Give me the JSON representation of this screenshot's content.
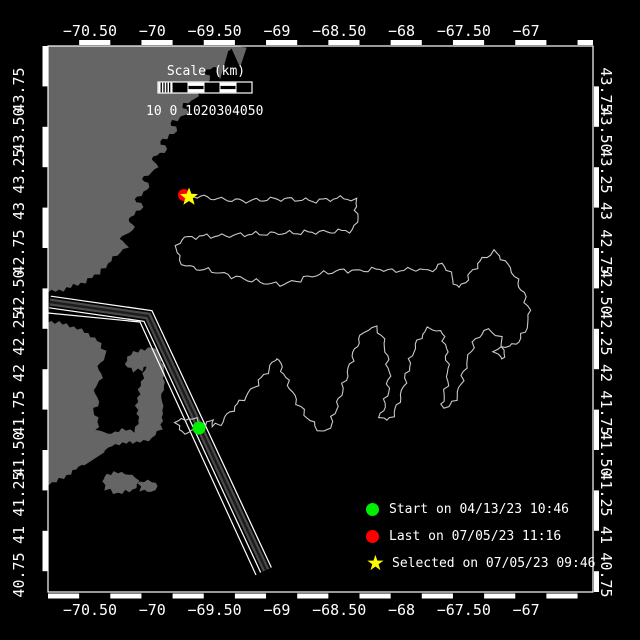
{
  "axes": {
    "lon": [
      {
        "label": "−70.50",
        "value": -70.5
      },
      {
        "label": "−70",
        "value": -70
      },
      {
        "label": "−69.50",
        "value": -69.5
      },
      {
        "label": "−69",
        "value": -69
      },
      {
        "label": "−68.50",
        "value": -68.5
      },
      {
        "label": "−68",
        "value": -68
      },
      {
        "label": "−67.50",
        "value": -67.5
      },
      {
        "label": "−67",
        "value": -67
      }
    ],
    "lat": [
      {
        "label": "43.75",
        "value": 43.75
      },
      {
        "label": "43.50",
        "value": 43.5
      },
      {
        "label": "43.25",
        "value": 43.25
      },
      {
        "label": "43",
        "value": 43
      },
      {
        "label": "42.75",
        "value": 42.75
      },
      {
        "label": "42.50",
        "value": 42.5
      },
      {
        "label": "42.25",
        "value": 42.25
      },
      {
        "label": "42",
        "value": 42
      },
      {
        "label": "41.75",
        "value": 41.75
      },
      {
        "label": "41.50",
        "value": 41.5
      },
      {
        "label": "41.25",
        "value": 41.25
      },
      {
        "label": "41",
        "value": 41
      },
      {
        "label": "40.75",
        "value": 40.75
      }
    ]
  },
  "scale_bar": {
    "title": "Scale (km)",
    "tick_text": "10 0 1020304050"
  },
  "legend": {
    "star_glyph": "★",
    "items": [
      {
        "marker": "circle",
        "color": "#00ee00",
        "label": "Start on 04/13/23 10:46"
      },
      {
        "marker": "circle",
        "color": "#ff0000",
        "label": "Last on 07/05/23 11:16"
      },
      {
        "marker": "star",
        "color": "#ffff00",
        "label": "Selected on 07/05/23 09:46"
      }
    ]
  },
  "markers": {
    "start": {
      "x": 199,
      "y": 428,
      "color": "#00ee00"
    },
    "last": {
      "x": 184,
      "y": 195,
      "color": "#ff0000"
    },
    "selected": {
      "x": 189,
      "y": 197,
      "color": "#ffff00"
    }
  },
  "map": {
    "land_color": "#656565",
    "track_color": "#c9c9c9",
    "frame_color": "#ffffff",
    "lane_colors": {
      "edge": "#ffffff",
      "gap": "#000000",
      "fill": "#4a4a4a",
      "core": "#1c1c1c"
    },
    "land": [
      {
        "name": "massachusetts-north-coast",
        "rough": true,
        "points": [
          [
            40,
            40
          ],
          [
            236,
            40
          ],
          [
            230,
            50
          ],
          [
            214,
            56
          ],
          [
            221,
            64
          ],
          [
            203,
            72
          ],
          [
            210,
            80
          ],
          [
            192,
            88
          ],
          [
            199,
            96
          ],
          [
            180,
            106
          ],
          [
            188,
            113
          ],
          [
            169,
            123
          ],
          [
            177,
            131
          ],
          [
            159,
            141
          ],
          [
            167,
            149
          ],
          [
            150,
            159
          ],
          [
            158,
            167
          ],
          [
            141,
            179
          ],
          [
            150,
            187
          ],
          [
            134,
            199
          ],
          [
            143,
            207
          ],
          [
            127,
            219
          ],
          [
            135,
            227
          ],
          [
            119,
            239
          ],
          [
            127,
            247
          ],
          [
            113,
            257
          ],
          [
            105,
            267
          ],
          [
            95,
            275
          ],
          [
            81,
            283
          ],
          [
            63,
            289
          ],
          [
            40,
            293
          ]
        ]
      },
      {
        "name": "coast-finger-1",
        "rough": false,
        "points": [
          [
            190,
            46
          ],
          [
            197,
            70
          ],
          [
            205,
            48
          ]
        ]
      },
      {
        "name": "coast-finger-2",
        "rough": false,
        "points": [
          [
            210,
            46
          ],
          [
            220,
            78
          ],
          [
            228,
            50
          ]
        ]
      },
      {
        "name": "coast-finger-3",
        "rough": false,
        "points": [
          [
            231,
            46
          ],
          [
            240,
            66
          ],
          [
            246,
            48
          ]
        ]
      },
      {
        "name": "cape-cod-mainland",
        "rough": true,
        "points": [
          [
            40,
            320
          ],
          [
            70,
            326
          ],
          [
            88,
            334
          ],
          [
            100,
            344
          ],
          [
            106,
            356
          ],
          [
            97,
            366
          ],
          [
            102,
            378
          ],
          [
            93,
            390
          ],
          [
            99,
            402
          ],
          [
            92,
            412
          ],
          [
            99,
            422
          ],
          [
            95,
            430
          ],
          [
            108,
            434
          ],
          [
            122,
            430
          ],
          [
            134,
            432
          ],
          [
            139,
            424
          ],
          [
            137,
            410
          ],
          [
            139,
            394
          ],
          [
            143,
            378
          ],
          [
            147,
            366
          ],
          [
            142,
            370
          ],
          [
            134,
            370
          ],
          [
            126,
            364
          ],
          [
            131,
            355
          ],
          [
            141,
            350
          ],
          [
            152,
            348
          ],
          [
            160,
            353
          ],
          [
            163,
            366
          ],
          [
            164,
            382
          ],
          [
            161,
            398
          ],
          [
            163,
            414
          ],
          [
            160,
            428
          ],
          [
            152,
            438
          ],
          [
            140,
            442
          ],
          [
            126,
            441
          ],
          [
            112,
            446
          ],
          [
            99,
            453
          ],
          [
            85,
            463
          ],
          [
            70,
            473
          ],
          [
            56,
            481
          ],
          [
            40,
            486
          ]
        ]
      },
      {
        "name": "elizabeth-islands",
        "rough": false,
        "points": [
          [
            78,
            458
          ],
          [
            98,
            447
          ],
          [
            104,
            452
          ],
          [
            84,
            465
          ]
        ]
      },
      {
        "name": "marthas-vineyard",
        "rough": true,
        "points": [
          [
            104,
            477
          ],
          [
            118,
            473
          ],
          [
            132,
            475
          ],
          [
            138,
            481
          ],
          [
            133,
            490
          ],
          [
            118,
            493
          ],
          [
            106,
            489
          ]
        ]
      },
      {
        "name": "nantucket",
        "rough": true,
        "points": [
          [
            140,
            483
          ],
          [
            152,
            481
          ],
          [
            158,
            486
          ],
          [
            151,
            492
          ],
          [
            141,
            490
          ]
        ]
      }
    ],
    "lane": {
      "center": [
        [
          50,
          302
        ],
        [
          148,
          316
        ],
        [
          266,
          570
        ]
      ],
      "parallel": [
        [
          48,
          313
        ],
        [
          140,
          322
        ],
        [
          256,
          575
        ]
      ]
    },
    "track": [
      [
        199,
        428
      ],
      [
        189,
        433
      ],
      [
        179,
        430
      ],
      [
        176,
        423
      ],
      [
        185,
        418
      ],
      [
        196,
        420
      ],
      [
        205,
        426
      ],
      [
        214,
        419
      ],
      [
        212,
        427
      ],
      [
        220,
        424
      ],
      [
        230,
        412
      ],
      [
        243,
        399
      ],
      [
        257,
        384
      ],
      [
        269,
        369
      ],
      [
        277,
        357
      ],
      [
        284,
        374
      ],
      [
        292,
        392
      ],
      [
        300,
        407
      ],
      [
        308,
        418
      ],
      [
        315,
        426
      ],
      [
        322,
        432
      ],
      [
        328,
        431
      ],
      [
        332,
        421
      ],
      [
        337,
        406
      ],
      [
        343,
        388
      ],
      [
        349,
        368
      ],
      [
        355,
        349
      ],
      [
        361,
        336
      ],
      [
        368,
        329
      ],
      [
        376,
        328
      ],
      [
        382,
        335
      ],
      [
        386,
        352
      ],
      [
        389,
        372
      ],
      [
        388,
        392
      ],
      [
        384,
        407
      ],
      [
        380,
        417
      ],
      [
        387,
        421
      ],
      [
        395,
        412
      ],
      [
        401,
        395
      ],
      [
        407,
        374
      ],
      [
        413,
        352
      ],
      [
        420,
        337
      ],
      [
        428,
        329
      ],
      [
        437,
        329
      ],
      [
        444,
        337
      ],
      [
        447,
        356
      ],
      [
        448,
        377
      ],
      [
        445,
        394
      ],
      [
        441,
        404
      ],
      [
        449,
        408
      ],
      [
        457,
        396
      ],
      [
        463,
        376
      ],
      [
        469,
        355
      ],
      [
        476,
        339
      ],
      [
        484,
        331
      ],
      [
        493,
        331
      ],
      [
        500,
        338
      ],
      [
        504,
        350
      ],
      [
        502,
        360
      ],
      [
        495,
        352
      ],
      [
        501,
        346
      ],
      [
        510,
        347
      ],
      [
        518,
        341
      ],
      [
        525,
        332
      ],
      [
        529,
        319
      ],
      [
        528,
        306
      ],
      [
        523,
        293
      ],
      [
        517,
        280
      ],
      [
        510,
        268
      ],
      [
        502,
        258
      ],
      [
        494,
        252
      ],
      [
        486,
        256
      ],
      [
        478,
        264
      ],
      [
        471,
        273
      ],
      [
        465,
        282
      ],
      [
        459,
        288
      ],
      [
        453,
        280
      ],
      [
        448,
        269
      ],
      [
        442,
        264
      ],
      [
        436,
        268
      ],
      [
        428,
        271
      ],
      [
        416,
        269
      ],
      [
        404,
        270
      ],
      [
        392,
        271
      ],
      [
        380,
        269
      ],
      [
        368,
        270
      ],
      [
        356,
        271
      ],
      [
        344,
        270
      ],
      [
        332,
        272
      ],
      [
        320,
        274
      ],
      [
        308,
        277
      ],
      [
        296,
        281
      ],
      [
        284,
        284
      ],
      [
        272,
        284
      ],
      [
        260,
        282
      ],
      [
        248,
        280
      ],
      [
        236,
        277
      ],
      [
        224,
        274
      ],
      [
        212,
        271
      ],
      [
        200,
        269
      ],
      [
        190,
        267
      ],
      [
        182,
        264
      ],
      [
        178,
        256
      ],
      [
        177,
        246
      ],
      [
        181,
        239
      ],
      [
        192,
        237
      ],
      [
        207,
        236
      ],
      [
        222,
        236
      ],
      [
        237,
        235
      ],
      [
        252,
        234
      ],
      [
        267,
        234
      ],
      [
        282,
        233
      ],
      [
        297,
        233
      ],
      [
        312,
        232
      ],
      [
        327,
        232
      ],
      [
        342,
        231
      ],
      [
        353,
        230
      ],
      [
        357,
        222
      ],
      [
        357,
        210
      ],
      [
        355,
        200
      ],
      [
        344,
        198
      ],
      [
        330,
        199
      ],
      [
        316,
        201
      ],
      [
        302,
        200
      ],
      [
        288,
        199
      ],
      [
        274,
        199
      ],
      [
        260,
        200
      ],
      [
        246,
        201
      ],
      [
        232,
        200
      ],
      [
        218,
        199
      ],
      [
        204,
        197
      ],
      [
        194,
        196
      ],
      [
        186,
        196
      ]
    ]
  }
}
